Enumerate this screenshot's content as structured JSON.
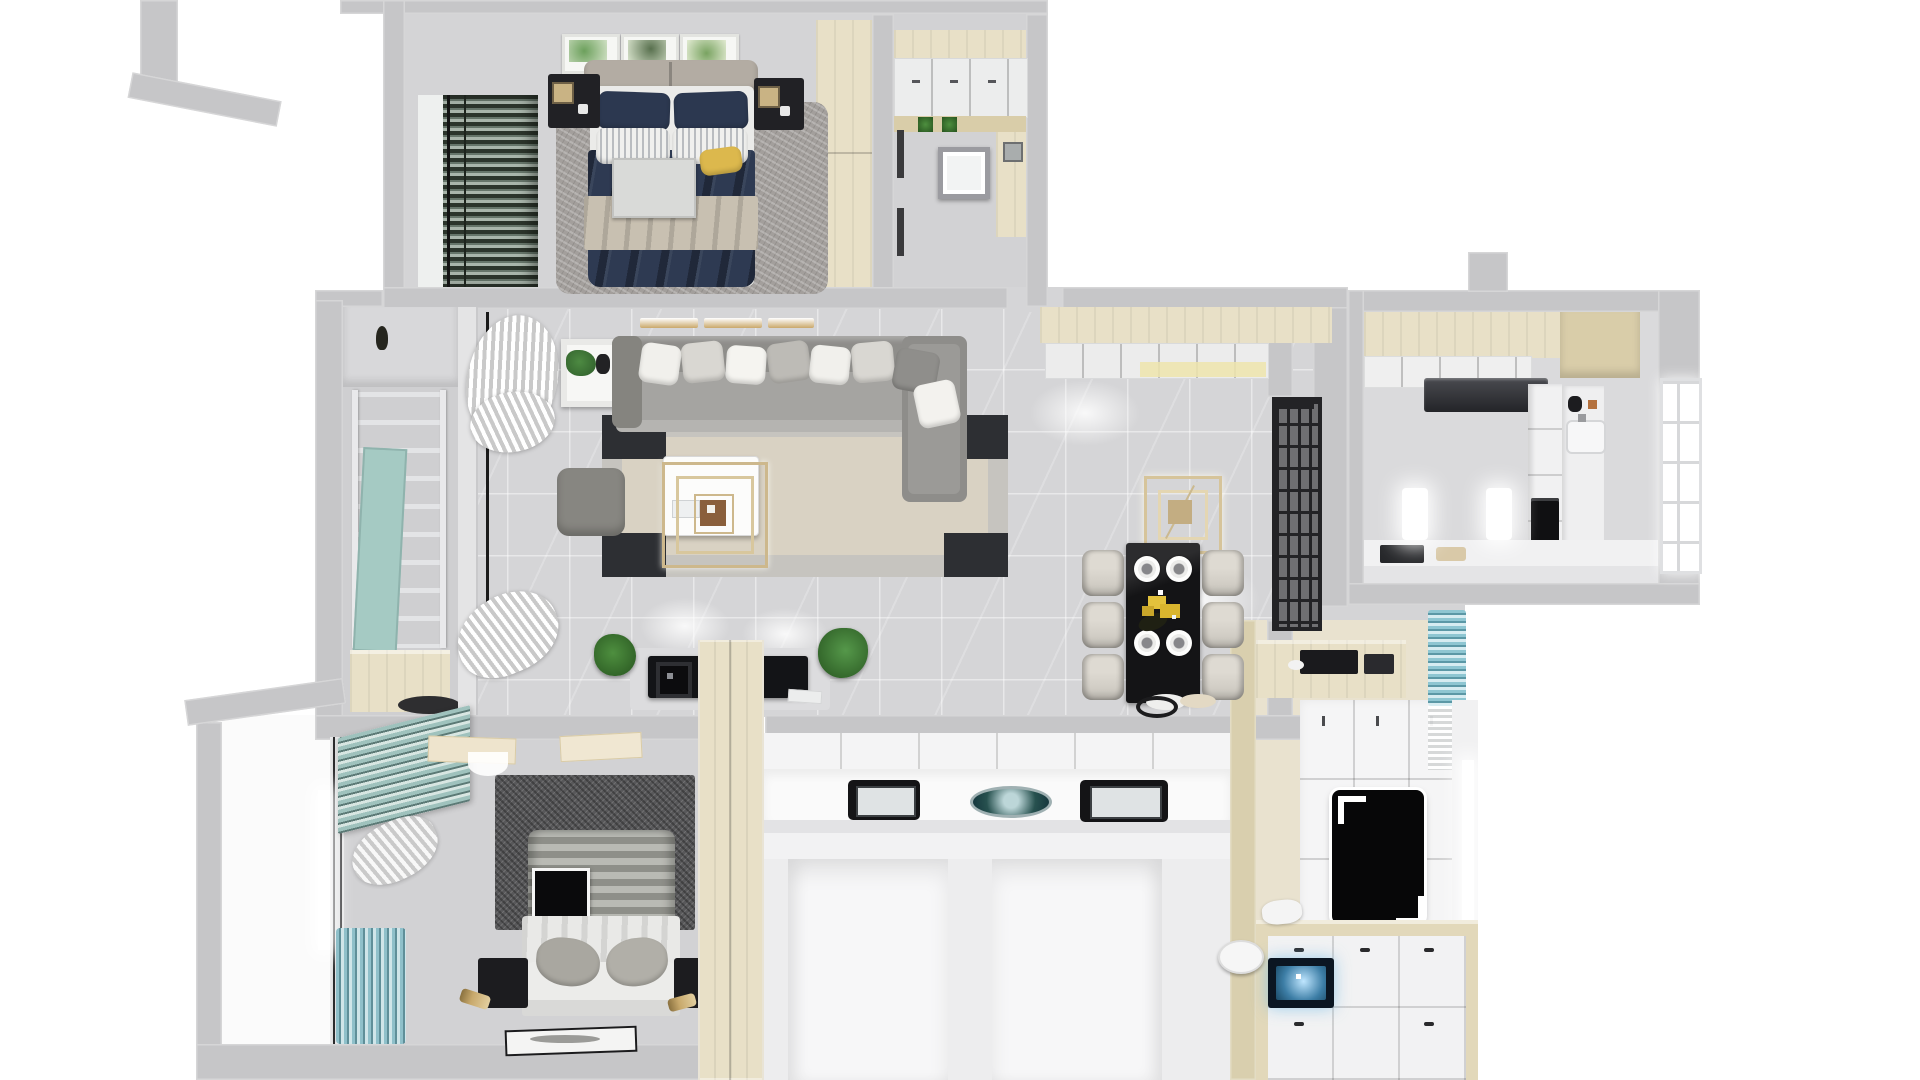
{
  "meta": {
    "description": "Photoreal 3D top-down dollhouse render of a two-bedroom apartment floor plan, no visible text labels",
    "view": "top-down 3D floor plan",
    "background": "#ffffff"
  },
  "palette": {
    "wall": "#c6c6c8",
    "wallLight": "#d8d8da",
    "floor": "#d5d5d7",
    "floorDark": "#cdcdcf",
    "white": "#f2f2f3",
    "wood": "#e8e0c7",
    "woodDark": "#d9cda9",
    "navy": "#2e3a52",
    "beige": "#c8c0b1",
    "gold": "#c9b384",
    "black": "#17181a",
    "tealBlind": "#9fc2bd",
    "tealCurtain": "#79aebc",
    "green": "#3f7d35",
    "rugLight": "#a39f9c",
    "rugDark": "#58585a",
    "chair": "#d6d2ca",
    "glowBlue": "#8fd0f0",
    "headboard": "#b3aca3",
    "sofa": "#8e8d8a"
  },
  "rooms": [
    {
      "id": "bedroom-master",
      "name": "master bedroom (top left)",
      "furniture": [
        "double bed with navy duvet and beige throw",
        "two navy pillows",
        "two striped pillows",
        "yellow accent pillow",
        "white bed tray",
        "gray padded headboard",
        "two black nightstands with lamps",
        "three botanical wall prints",
        "gray shag rug",
        "dark green window blinds",
        "wooden wardrobe"
      ]
    },
    {
      "id": "entry-laundry",
      "name": "entry / laundry (top middle)",
      "furniture": [
        "white wall cabinets",
        "wooden shelf with plants",
        "round washing machine",
        "wooden side counter",
        "wall art"
      ]
    },
    {
      "id": "living-room",
      "name": "living room (center)",
      "furniture": [
        "gray sectional sofa with seven cushions",
        "edge-on art frames",
        "white round side table with plant",
        "white gathered curtains",
        "beige rug with black corners",
        "white coffee table",
        "gold ring ceiling lamp",
        "gray ottoman",
        "black TV console with speaker",
        "two potted plants",
        "floor mat"
      ]
    },
    {
      "id": "dining-room",
      "name": "dining room (center right)",
      "furniture": [
        "black dining table",
        "six beige upholstered chairs",
        "four place settings",
        "yellow flower centerpiece",
        "double gold ring chandelier",
        "white sideboard cabinets with under-light",
        "black lattice glass partition",
        "serving trays"
      ]
    },
    {
      "id": "kitchen",
      "name": "kitchen (top right)",
      "furniture": [
        "cream upper cabinets",
        "white cabinet fronts",
        "dark range hood",
        "tall cabinet with built-in black oven",
        "sink with faucet",
        "side counter with kettle",
        "bottom counter",
        "paned window",
        "two glowing wall lights",
        "wall vent stub"
      ]
    },
    {
      "id": "balcony",
      "name": "balcony (far left)",
      "furniture": [
        "metal drying rack",
        "teal board",
        "hanging lantern",
        "wooden storage bench",
        "dark floor mat"
      ]
    },
    {
      "id": "bedroom-second",
      "name": "second bedroom (bottom left)",
      "furniture": [
        "bed with gray striped duvet",
        "black round hat on bed",
        "white blanket",
        "gray crumpled pillows",
        "two black nightstands",
        "two toppled gold lamps",
        "dark shag rug",
        "angled teal venetian blinds",
        "teal pleated curtains",
        "framed picture lying on floor",
        "open closet doors"
      ]
    },
    {
      "id": "bathroom-block",
      "name": "bathroom / vanity block (bottom middle)",
      "furniture": [
        "tall cream cabinet column",
        "white vanity counter",
        "two dark open laptops-style basins",
        "decorative teal round plate",
        "white shower cubicle",
        "white toilet cubicle"
      ]
    },
    {
      "id": "tatami-room",
      "name": "tatami room (bottom right)",
      "furniture": [
        "wooden sideboard with black trays",
        "white wardrobe wall",
        "black dressing mirror with white corner brackets",
        "storage platform bed with white pads",
        "glowing blue screen",
        "white stool",
        "teal curtain",
        "bright window sill"
      ]
    },
    {
      "id": "outdoor-platform",
      "name": "outdoor ledge (bottom left corner)",
      "furniture": [
        "bare white platform",
        "angled parapet walls"
      ]
    }
  ]
}
